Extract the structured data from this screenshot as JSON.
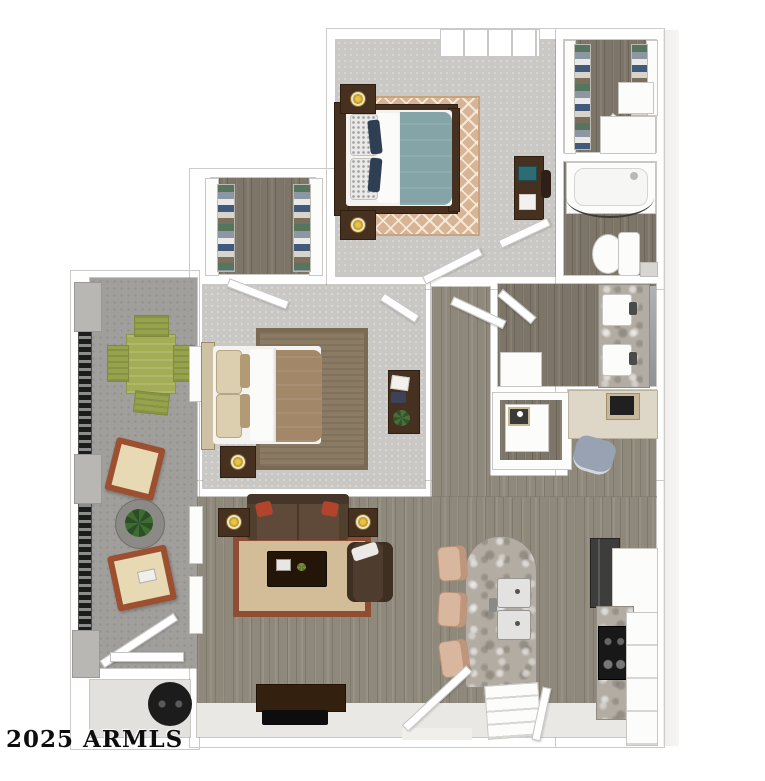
{
  "watermark": {
    "text": "2025 ARMLS"
  },
  "colors": {
    "wallOutline": "#cccbc8",
    "carpet": "#c9c8c5",
    "woodLight": "#8f897c",
    "woodDark": "#7d7568",
    "concrete": "#a09f9c",
    "granite": "#b2aca3",
    "darkWood": "#46301f",
    "gold": "#c9a22a",
    "tealBed": "#84a4a7",
    "tanRug": "#d7b495",
    "brownBed": "#a28768",
    "sofaBrown": "#5f4a39",
    "redPillow": "#b2442e",
    "rugBorder": "#8f4d33",
    "rugCenter": "#d3bd98",
    "olive": "#a3ad56",
    "rust": "#9c5030",
    "cream": "#e7d9b4",
    "applianceDark": "#3d3d3b",
    "stoolTan": "#d9b79f"
  }
}
